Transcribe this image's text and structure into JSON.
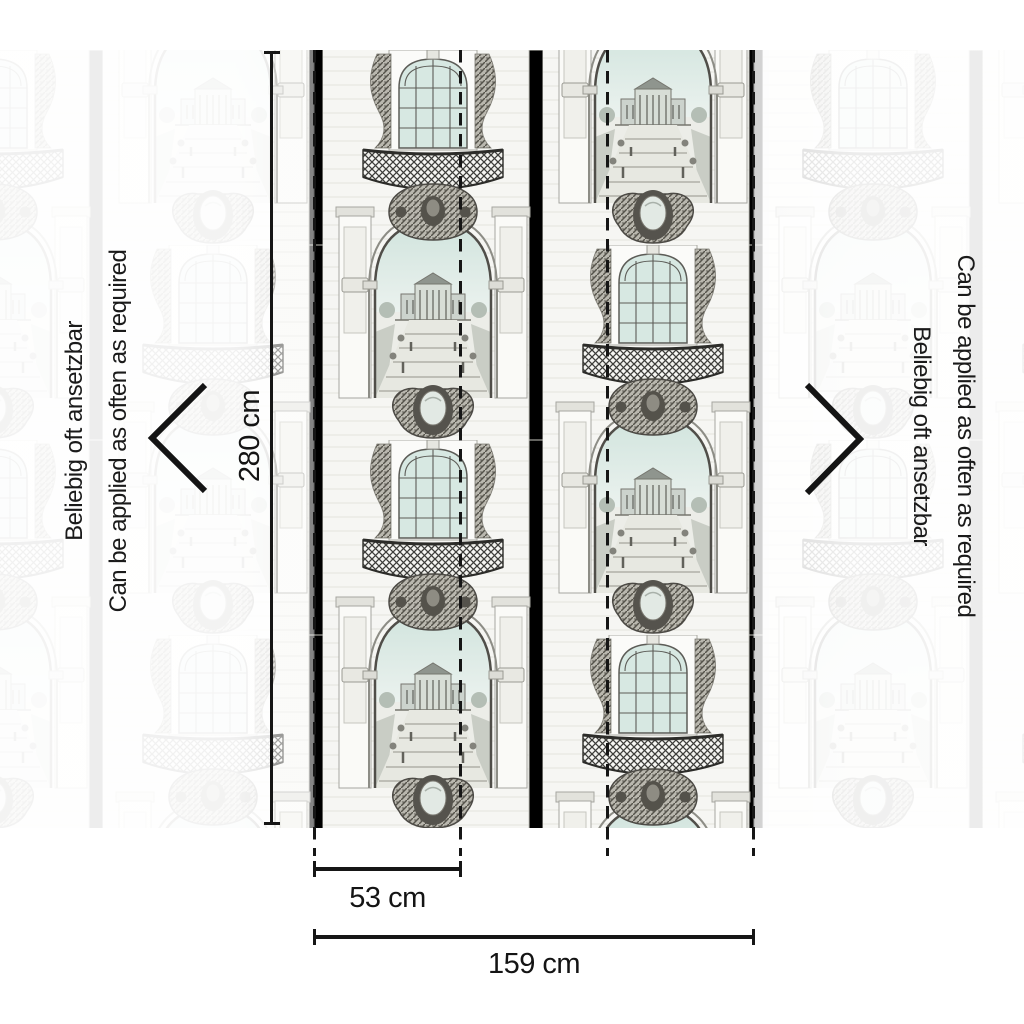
{
  "measurements": {
    "height": "280 cm",
    "panel_width": "53 cm",
    "total_width": "159 cm"
  },
  "side_note": {
    "de": "Beliebig oft ansetzbar",
    "en": "Can be applied as often as required"
  },
  "icons": {
    "left_arrow": "chevron-left",
    "right_arrow": "chevron-right"
  },
  "pattern": {
    "motif": "Baroque palace facade etching: arched windows, iron balconies, grand arches opening onto palace garden vistas",
    "tint": "#d7e8e2",
    "line_color": "#161616"
  }
}
